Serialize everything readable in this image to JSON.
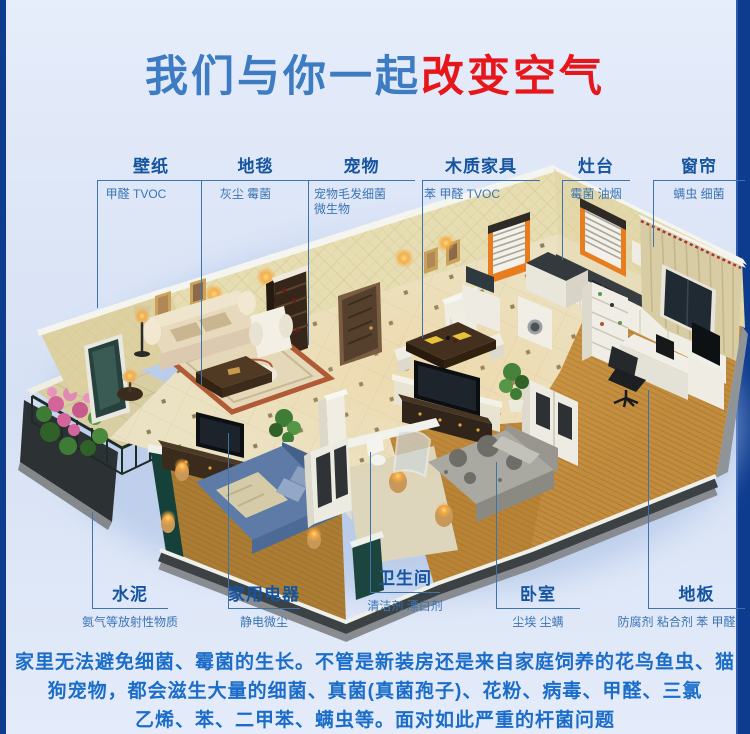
{
  "title": {
    "part_blue": "我们与你一起",
    "part_red": "改变空气"
  },
  "palette": {
    "title_blue": "#3d7cc2",
    "title_red": "#e7161b",
    "label_title_blue": "#15549f",
    "label_desc_blue": "#3a74b4",
    "callout_line": "#3e74ad",
    "footer_blue": "#1b6dc9",
    "side_strip_navy": "#0d3b8e",
    "background_light_blue": "#dbe5f6",
    "accent_orange_window": "#e87d20"
  },
  "hotspots": {
    "wallpaper": {
      "title": "壁纸",
      "desc": "甲醛 TVOC"
    },
    "carpet": {
      "title": "地毯",
      "desc": "灰尘 霉菌"
    },
    "pets": {
      "title": "宠物",
      "desc": "宠物毛发细菌",
      "desc2": "微生物"
    },
    "wood_furniture": {
      "title": "木质家具",
      "desc": "苯 甲醛 TVOC"
    },
    "stove": {
      "title": "灶台",
      "desc": "霉菌 油烟"
    },
    "curtain": {
      "title": "窗帘",
      "desc": "螨虫 细菌"
    },
    "cement": {
      "title": "水泥",
      "desc": "氨气等放射性物质"
    },
    "appliances": {
      "title": "家用电器",
      "desc": "静电微尘"
    },
    "bathroom": {
      "title": "卫生间",
      "desc": "清洁剂 漂白剂"
    },
    "bedroom": {
      "title": "卧室",
      "desc": "尘埃 尘螨"
    },
    "floor": {
      "title": "地板",
      "desc": "防腐剂 粘合剂 苯 甲醛"
    }
  },
  "footer": {
    "line1": "家里无法避免细菌、霉菌的生长。不管是新装房还是来自家庭饲养的花鸟鱼虫、猫",
    "line2": "狗宠物，都会滋生大量的细菌、真菌(真菌孢子)、花粉、病毒、甲醛、三氯",
    "line3": "乙烯、苯、二甲苯、螨虫等。面对如此严重的杆菌问题"
  }
}
